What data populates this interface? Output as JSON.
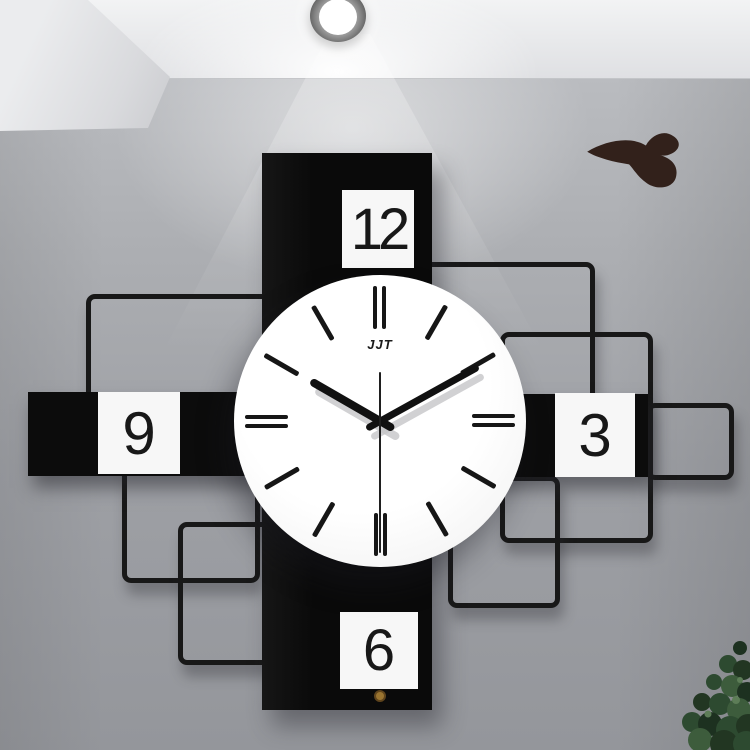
{
  "scene": {
    "description": "Modern geometric wall clock hanging on a gray wall, lit by a ceiling spotlight, with a bird wall decal and a green plant in the lower-right corner",
    "wall_color": "#a6a8ac",
    "ceiling_color": "#ececee"
  },
  "spotlight": {
    "ring_color": "#0e0e0e",
    "light_color": "#ffffff"
  },
  "bird_decal": {
    "color": "#32211b"
  },
  "clock": {
    "brand": "JJT",
    "numerals": {
      "n12": "12",
      "n3": "3",
      "n6": "6",
      "n9": "9"
    },
    "time_displayed": "10:10:30",
    "panel_color": "#0c0c0c",
    "face_color": "#fbfbfb",
    "tick_color": "#161616",
    "hand_color": "#111111",
    "second_hand_color": "#1f1f1f",
    "center_cap_color": "#9a7430",
    "hands": {
      "hour_deg": 300,
      "minute_deg": 61,
      "second_deg": 180
    },
    "ticks": {
      "count": 12,
      "double_at": [
        12,
        3,
        6,
        9
      ]
    }
  },
  "plant": {
    "colors": [
      "#1d3120",
      "#2d4a30",
      "#3d5c3c",
      "#5d7d57"
    ]
  }
}
